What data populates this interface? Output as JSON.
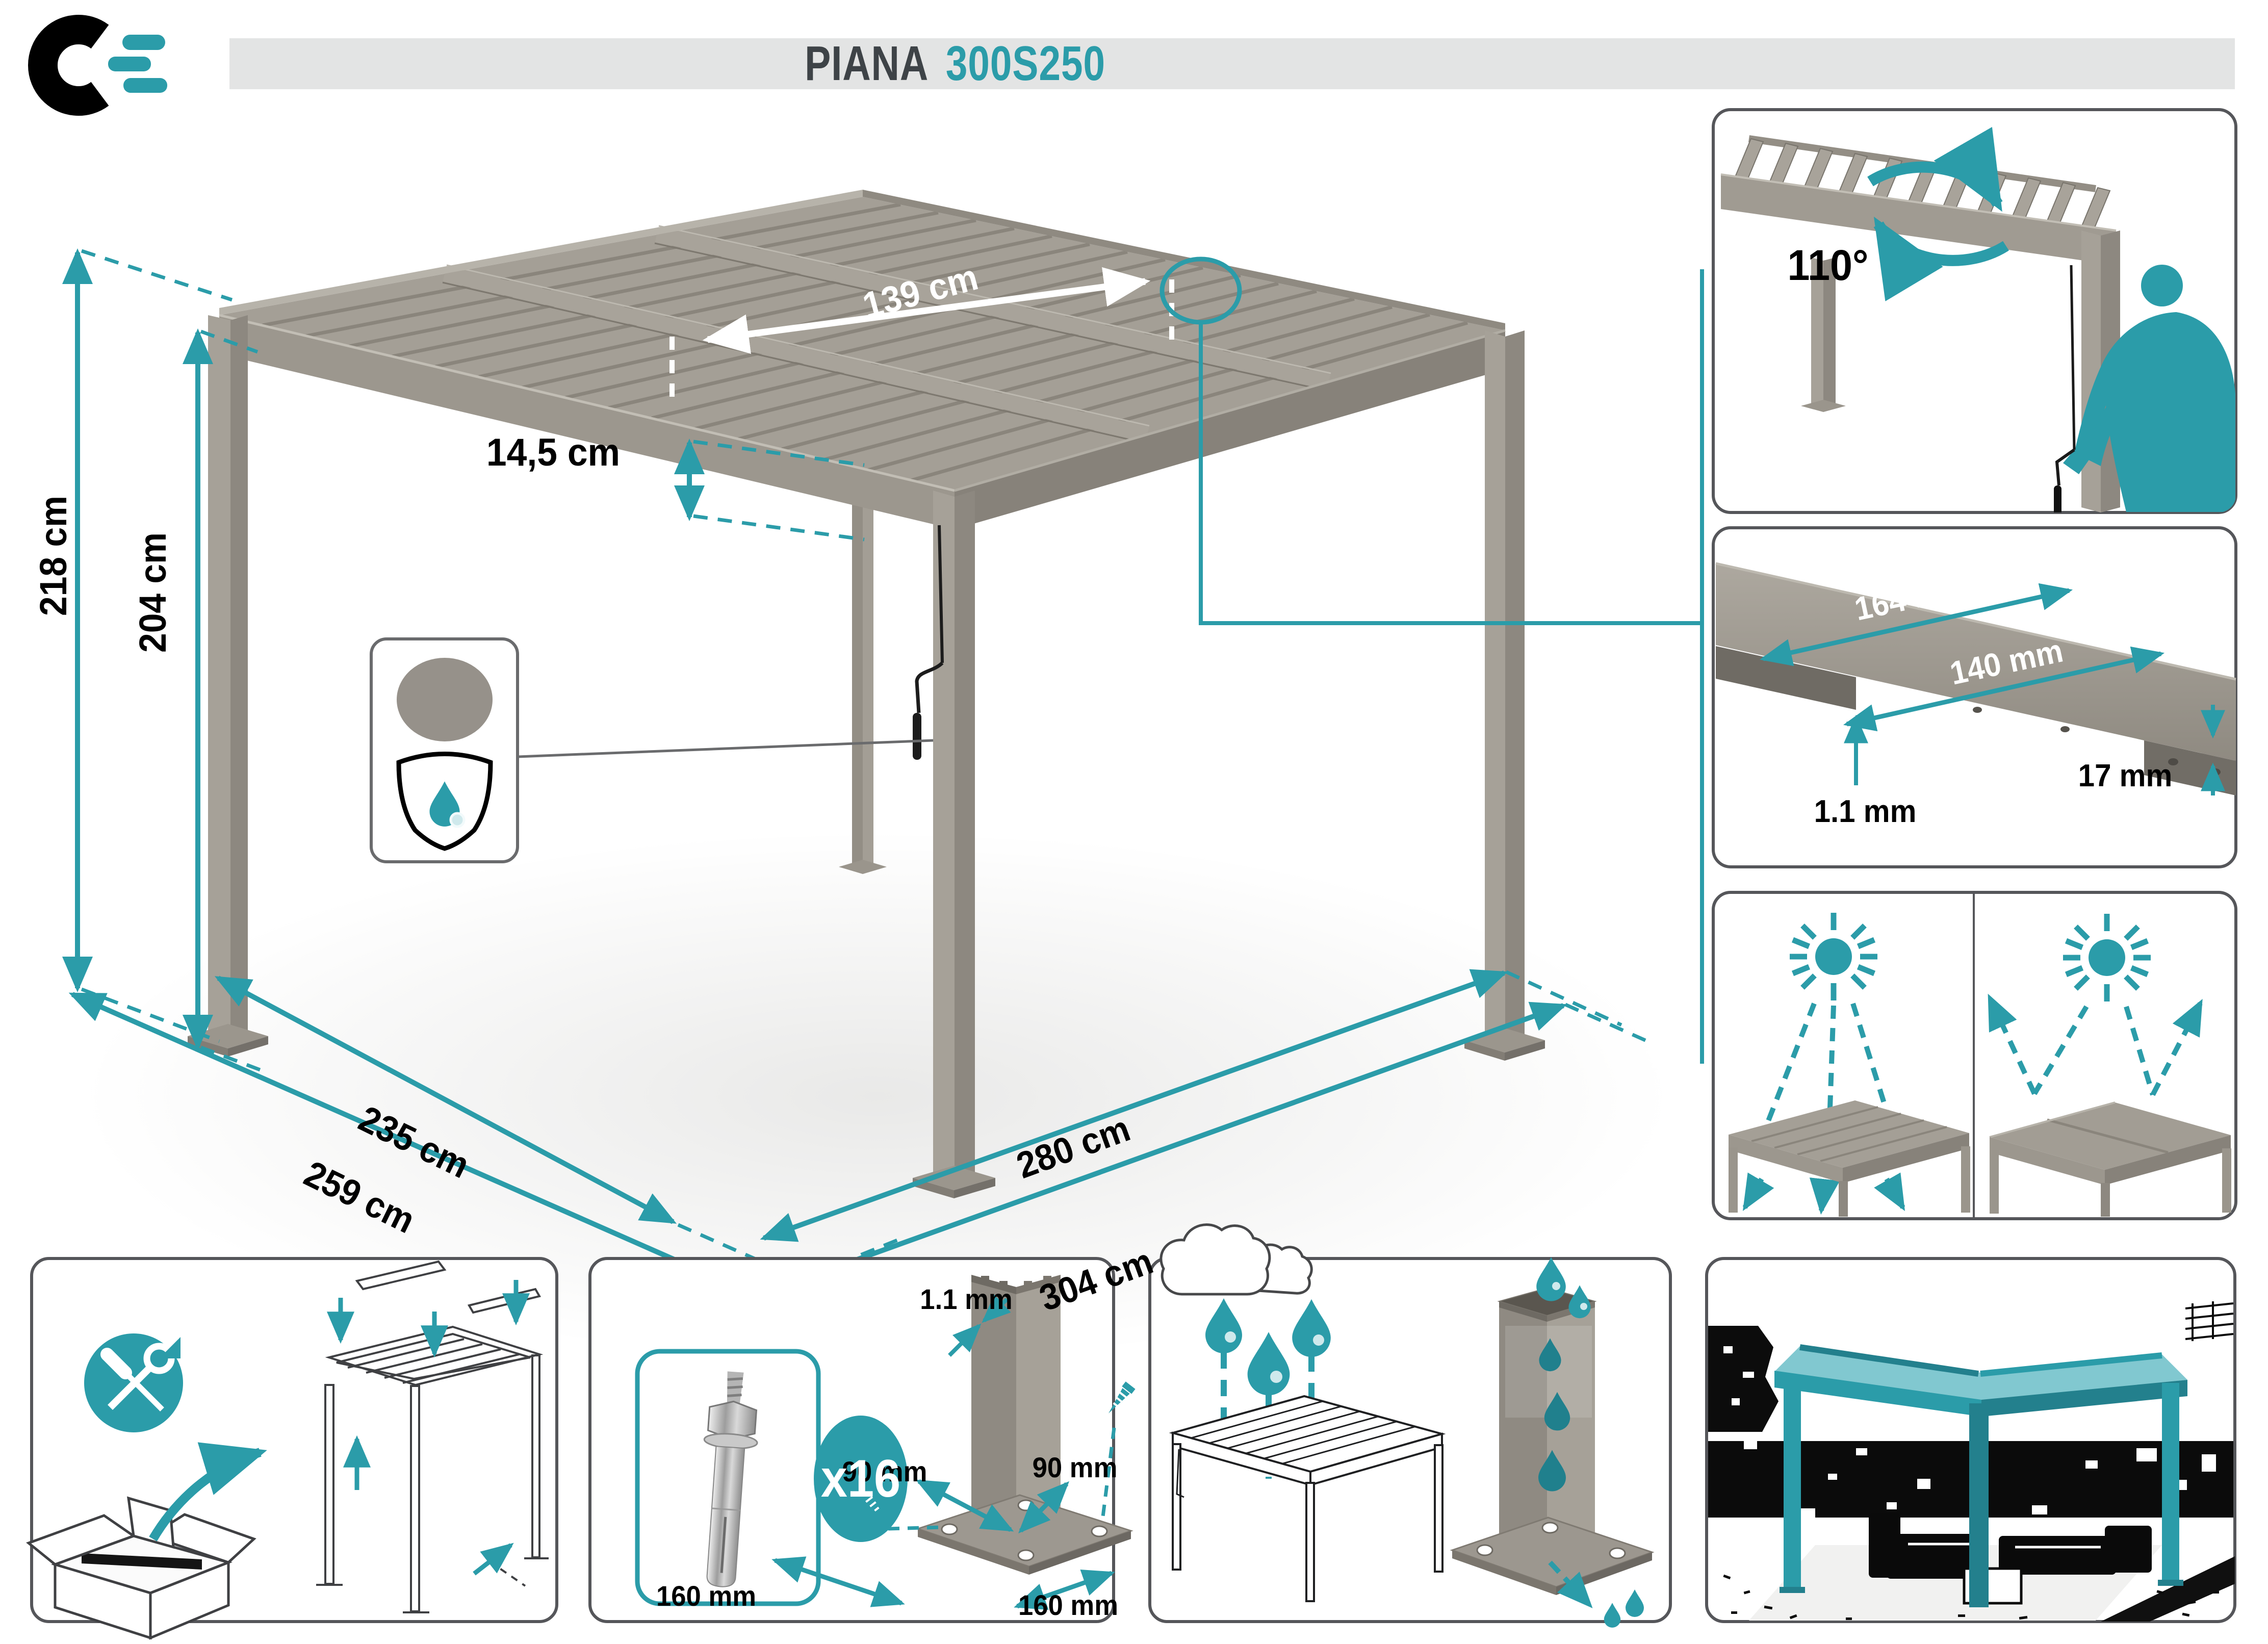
{
  "meta": {
    "domain": "Diagram",
    "kind": "pergola-specification-sheet"
  },
  "colors": {
    "teal": "#2B9CA9",
    "teal_dark": "#20808D",
    "title_dark": "#3E4347",
    "title_bar_bg": "#E3E4E4",
    "panel_border": "#55565A",
    "alu_light": "#B3AEA5",
    "alu_mid": "#A19C93",
    "alu_dark": "#8B867D",
    "swatch_gray": "#96918A",
    "line_art": "#3F4043"
  },
  "header": {
    "product_name": "PIANA",
    "model": "300S250"
  },
  "pergola_dimensions": {
    "height_total": "218 cm",
    "height_clear": "204 cm",
    "beam_height": "14,5 cm",
    "louver_bay_width": "139 cm",
    "side_inner": "235 cm",
    "side_outer": "259 cm",
    "front_inner": "280 cm",
    "front_outer": "304 cm"
  },
  "louver_rotation": {
    "angle": "110°"
  },
  "louver_profile": {
    "top_width": "164 mm",
    "bottom_width": "140 mm",
    "edge_height": "17 mm",
    "sheet_thickness": "1.1 mm"
  },
  "anchor_kit": {
    "bolt_count": "x16",
    "post_wall_thickness": "1.1 mm",
    "post_side_left": "90 mm",
    "post_side_right": "90 mm",
    "base_plate_left": "160 mm",
    "base_plate_right": "160 mm"
  }
}
